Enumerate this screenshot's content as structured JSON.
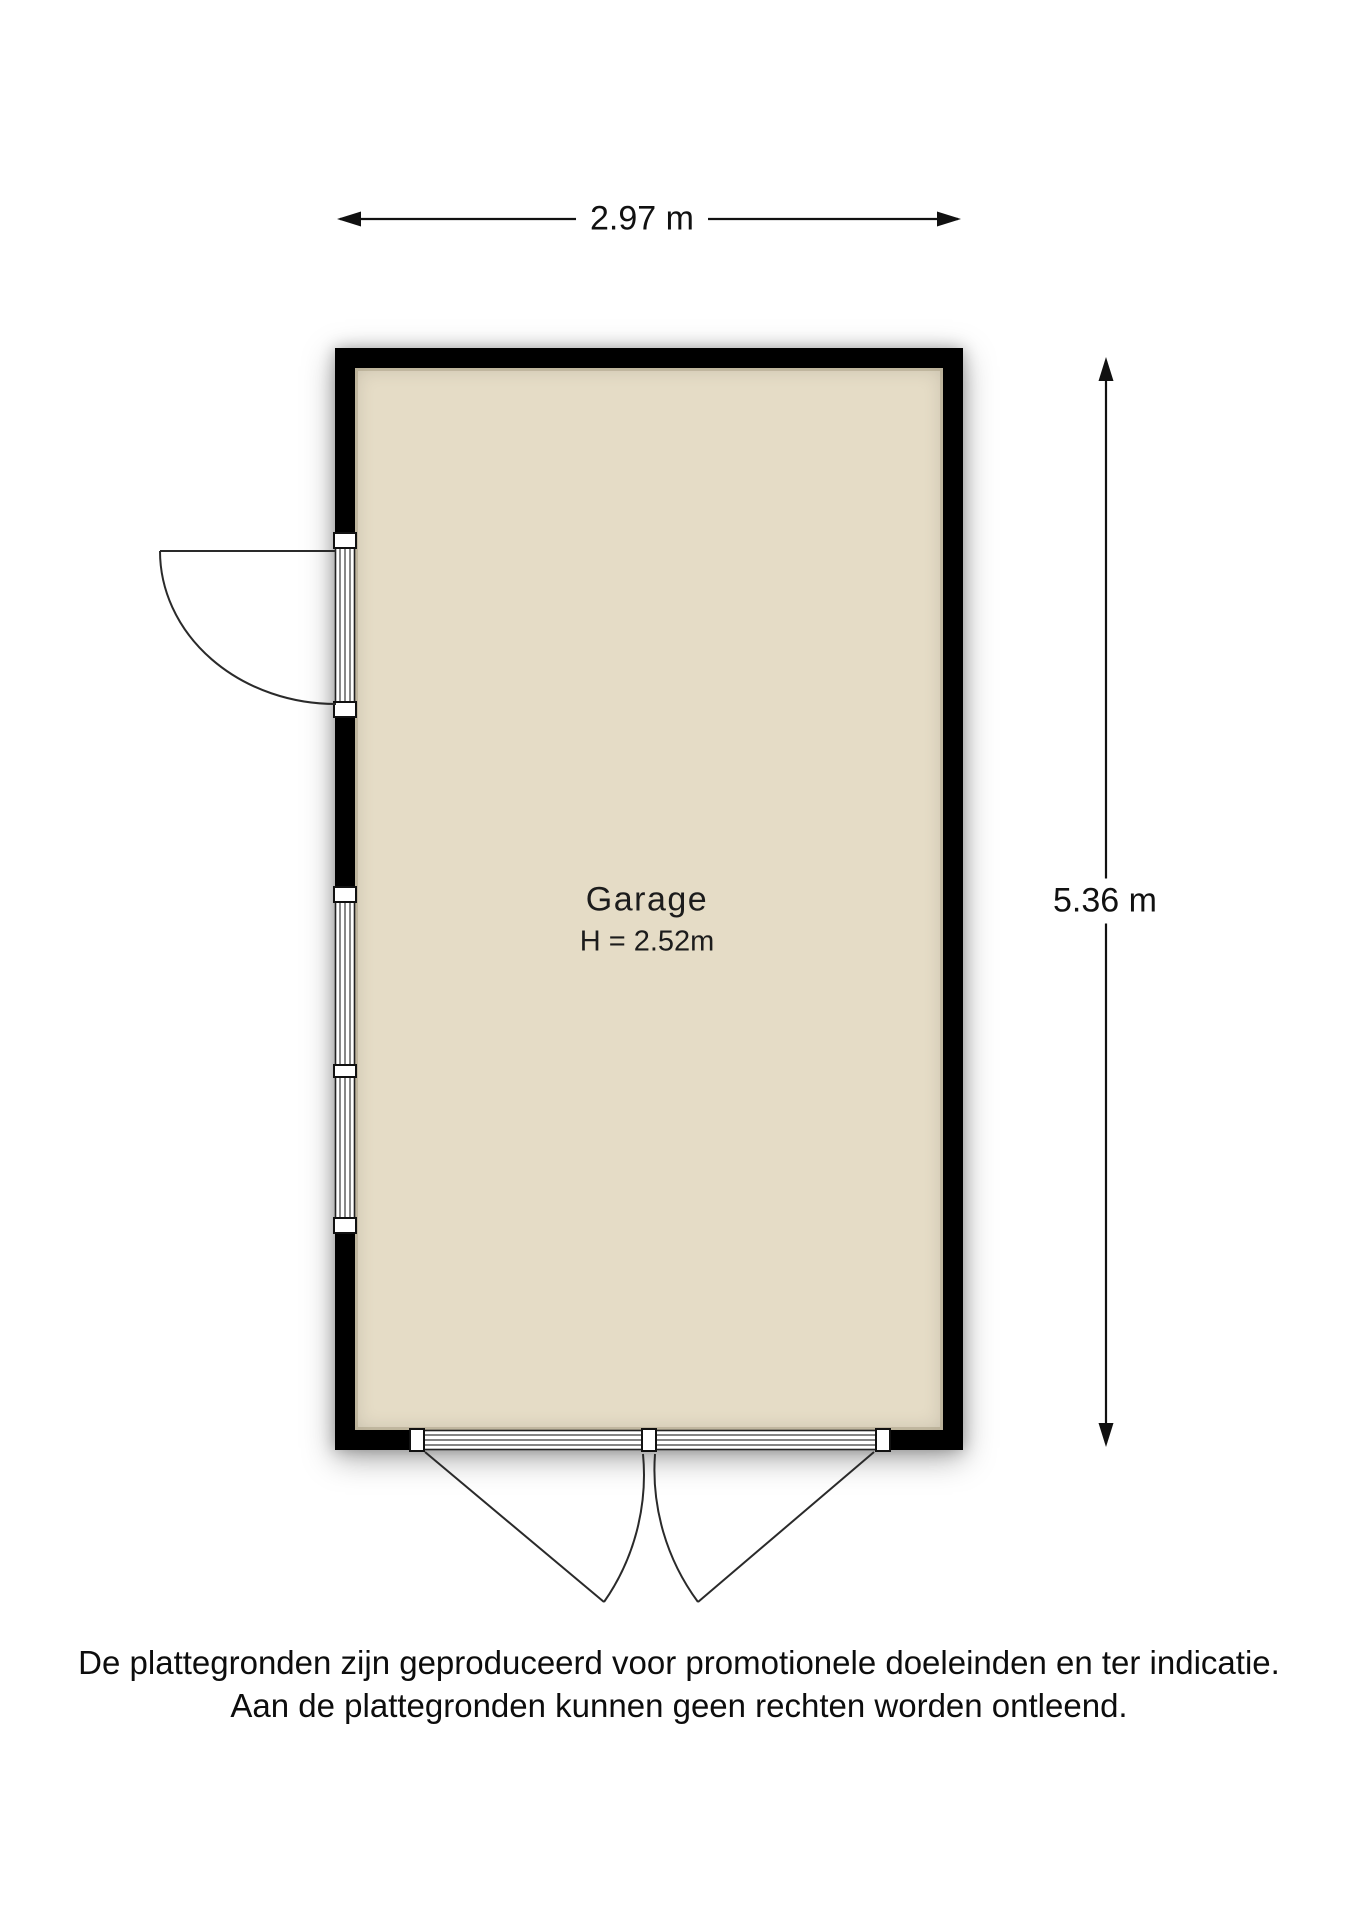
{
  "plan": {
    "type": "floor-plan",
    "room": {
      "name": "Garage",
      "height_label": "H = 2.52m"
    },
    "dimensions": {
      "width_label": "2.97 m",
      "height_label": "5.36 m"
    },
    "features": [
      "entry-door-left-wall",
      "window-left-wall",
      "double-garage-door-bottom-wall"
    ]
  },
  "disclaimer": {
    "line1": "De plattegronden zijn geproduceerd voor promotionele doeleinden en ter indicatie.",
    "line2": "Aan de plattegronden kunnen geen rechten worden ontleend."
  },
  "colors": {
    "wall": "#000000",
    "floor": "#e5dcc6",
    "bg": "#ffffff",
    "text": "#111111"
  }
}
